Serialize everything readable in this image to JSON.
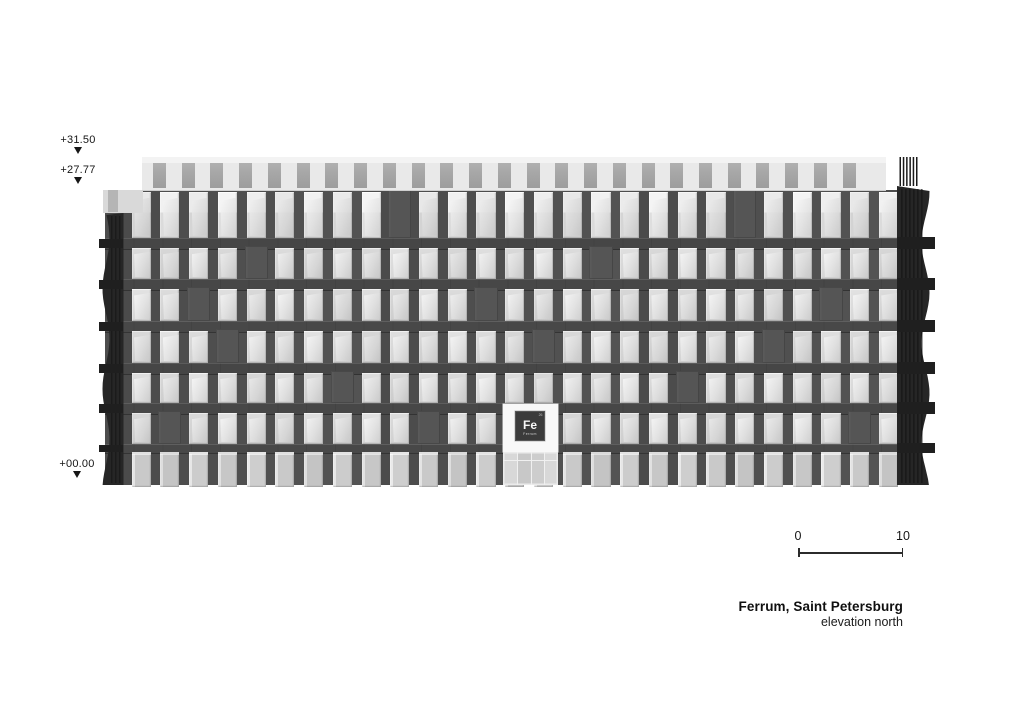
{
  "levels": [
    {
      "label": "+31.50",
      "x": 78,
      "label_top": 134,
      "note": "parapet top"
    },
    {
      "label": "+27.77",
      "x": 78,
      "label_top": 164,
      "note": "main roof line"
    },
    {
      "label": "+00.00",
      "x": 77,
      "label_top": 458,
      "note": "ground line"
    }
  ],
  "scale_bar": {
    "label_start": "0",
    "label_end": "10",
    "x1": 798,
    "x2": 903,
    "y": 548,
    "label_y": 529
  },
  "title_block": {
    "title": "Ferrum, Saint Petersburg",
    "subtitle": "elevation north",
    "right_x": 903,
    "top": 599
  },
  "logo": {
    "symbol": "Fe",
    "name": "Ferrum",
    "number": "26"
  },
  "drawing": {
    "canvas": {
      "w": 1024,
      "h": 724,
      "background": "#ffffff"
    },
    "building": {
      "facade_x": 105,
      "facade_right": 898,
      "facade_top": 190,
      "ground_y": 485,
      "grid_x": 122,
      "bays": 27,
      "column_w": 9.6,
      "parapet": {
        "x": 142,
        "right": 886,
        "top": 157,
        "bottom": 190,
        "slot_y": 163,
        "slot_h": 25,
        "slot_w": 13,
        "bg": "#e9e9e9",
        "top_strip": "#f3f3f3",
        "slot_color": "#a7a7a7"
      },
      "rows": [
        {
          "y": 192,
          "h": 46,
          "kind": "top"
        },
        {
          "y": 248,
          "h": 31,
          "kind": "mid"
        },
        {
          "y": 289,
          "h": 32,
          "kind": "mid"
        },
        {
          "y": 331,
          "h": 32,
          "kind": "mid"
        },
        {
          "y": 373,
          "h": 30,
          "kind": "mid"
        },
        {
          "y": 413,
          "h": 31,
          "kind": "mid"
        },
        {
          "y": 452,
          "h": 33,
          "kind": "ground"
        }
      ],
      "spandrels": [
        {
          "y": 238,
          "h": 10
        },
        {
          "y": 279,
          "h": 10
        },
        {
          "y": 321,
          "h": 10
        },
        {
          "y": 363,
          "h": 10
        },
        {
          "y": 403,
          "h": 10
        },
        {
          "y": 444,
          "h": 8
        }
      ],
      "weave_piers": [
        [
          0,
          9
        ],
        [
          0,
          21
        ],
        [
          1,
          4
        ],
        [
          1,
          16
        ],
        [
          2,
          2
        ],
        [
          2,
          12
        ],
        [
          2,
          24
        ],
        [
          3,
          3
        ],
        [
          3,
          14
        ],
        [
          3,
          22
        ],
        [
          4,
          7
        ],
        [
          4,
          19
        ],
        [
          5,
          1
        ],
        [
          5,
          10
        ],
        [
          5,
          25
        ]
      ],
      "colors": {
        "grid": "#4d4d4d",
        "column": "#4f4f4f",
        "spandrel": "#474747",
        "window_top": "#eeeeee",
        "window": "#dcdcdc",
        "ground_window": "#c9c9c9",
        "pier": "#555555",
        "fin": "#262626",
        "fin_stripe": "#141414",
        "tab": "#1f1f1f",
        "corner": "#d9d9d9",
        "corner_slot": "#b5b5b5"
      },
      "corner": {
        "x": 103,
        "y": 190,
        "w": 40,
        "h": 23
      },
      "entrance": {
        "panel": {
          "x": 503,
          "y": 404,
          "w": 55,
          "h": 48,
          "color": "#f8f8f8"
        },
        "logo": {
          "x": 515,
          "y": 411,
          "w": 30,
          "h": 30,
          "color": "#3b3b3b"
        },
        "glazing": {
          "x": 503,
          "y": 452,
          "w": 55,
          "h": 33,
          "color": "#d2d2d2"
        }
      }
    }
  }
}
